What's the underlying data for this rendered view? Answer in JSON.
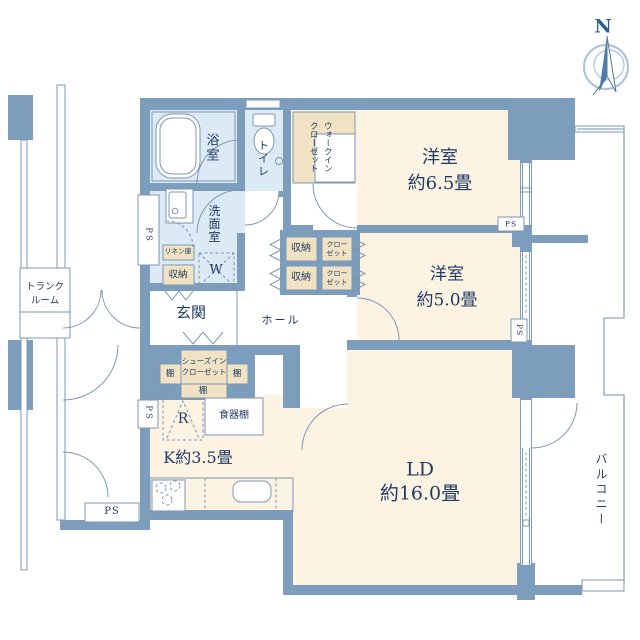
{
  "colors": {
    "wall": "#7d9dbd",
    "wet": "#dceaf5",
    "room": "#fdf3e3",
    "closet": "#f0e2c2",
    "line": "#7d97b5",
    "text": "#1f3c66",
    "balcony": "#8ca6bf",
    "compass": "#4d7ba8"
  },
  "compass": {
    "north": "N"
  },
  "rooms": {
    "bed1": {
      "name": "洋室",
      "size": "約6.5畳"
    },
    "bed2": {
      "name": "洋室",
      "size": "約5.0畳"
    },
    "ld": {
      "name": "LD",
      "size": "約16.0畳"
    },
    "kitchen": {
      "label": "K約3.5畳"
    },
    "bath": {
      "label": "浴室"
    },
    "toilet": {
      "label": "トイレ"
    },
    "washroom": {
      "label": "洗面室"
    },
    "genkan": {
      "label": "玄関"
    },
    "hall": {
      "label": "ホール"
    },
    "balcony": {
      "label": "バルコニー"
    },
    "trunk": {
      "line1": "トランク",
      "line2": "ルーム"
    },
    "wic": {
      "line1": "ウォークイン",
      "line2": "クローゼット"
    }
  },
  "fixtures": {
    "ps": "PS",
    "storage": "収納",
    "closet_line1": "クロー",
    "closet_line2": "ゼット",
    "linen": "リネン庫",
    "sic_line1": "シューズイン",
    "sic_line2": "クローゼット",
    "shelf": "棚",
    "dish_shelf": "食器棚",
    "washer": "W",
    "fridge": "R"
  }
}
